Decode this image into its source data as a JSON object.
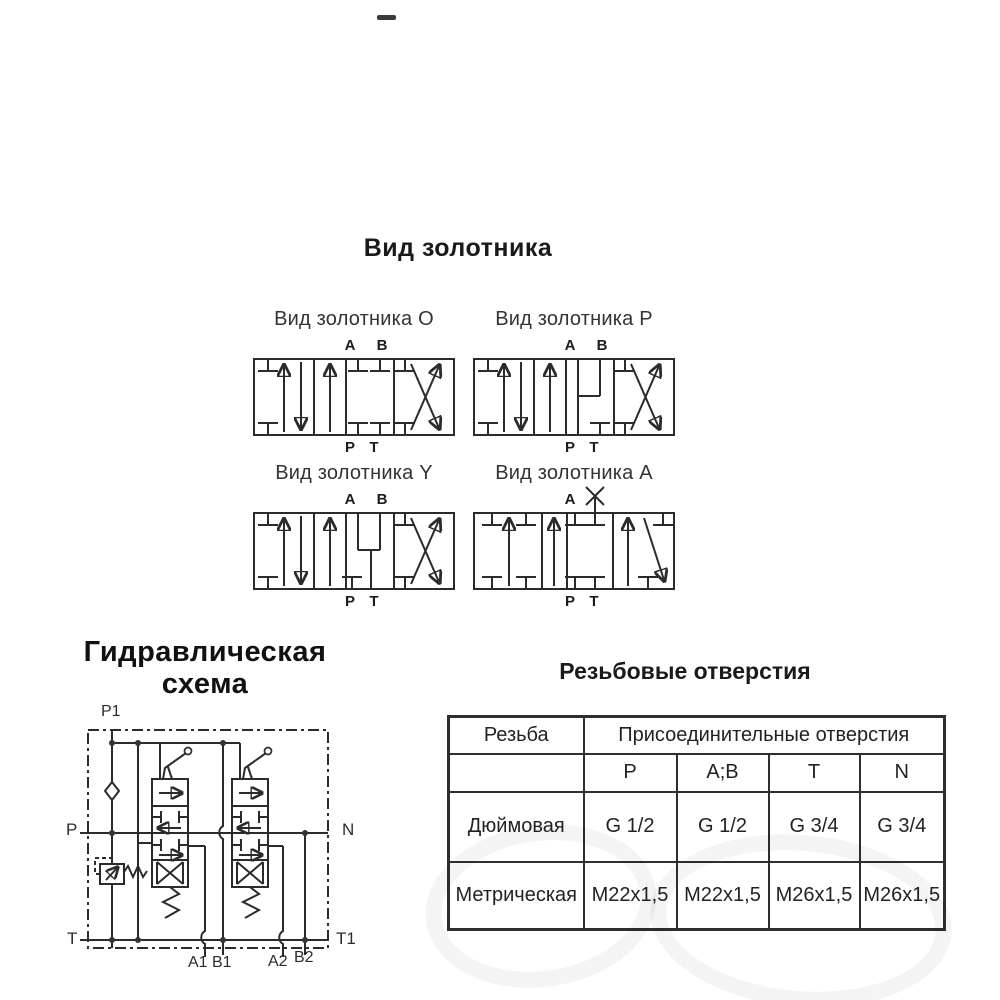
{
  "spool_section": {
    "title": "Вид золотника",
    "spools": [
      {
        "id": "O",
        "label": "Вид золотника O",
        "top_ports": [
          "A",
          "B"
        ],
        "bottom_ports": [
          "P",
          "T"
        ]
      },
      {
        "id": "P",
        "label": "Вид золотника P",
        "top_ports": [
          "A",
          "B"
        ],
        "bottom_ports": [
          "P",
          "T"
        ]
      },
      {
        "id": "Y",
        "label": "Вид золотника Y",
        "top_ports": [
          "A",
          "B"
        ],
        "bottom_ports": [
          "P",
          "T"
        ]
      },
      {
        "id": "A",
        "label": "Вид золотника A",
        "top_ports": [
          "A"
        ],
        "plugged_port": "B",
        "bottom_ports": [
          "P",
          "T"
        ]
      }
    ]
  },
  "hydraulic_section": {
    "title_line1": "Гидравлическая",
    "title_line2": "схема",
    "port_labels": {
      "p1": "P1",
      "p": "P",
      "n": "N",
      "t": "T",
      "t1": "T1",
      "a1": "A1",
      "b1": "B1",
      "a2": "A2",
      "b2": "B2"
    }
  },
  "thread_section": {
    "title": "Резьбовые отверстия",
    "table": {
      "col1_header": "Резьба",
      "group_header": "Присоединительные отверстия",
      "port_columns": [
        "P",
        "A;B",
        "T",
        "N"
      ],
      "rows": [
        {
          "name": "Дюймовая",
          "values": [
            "G 1/2",
            "G 1/2",
            "G 3/4",
            "G 3/4"
          ]
        },
        {
          "name": "Метрическая",
          "values": [
            "M22x1,5",
            "M22x1,5",
            "M26x1,5",
            "M26x1,5"
          ]
        }
      ]
    }
  }
}
